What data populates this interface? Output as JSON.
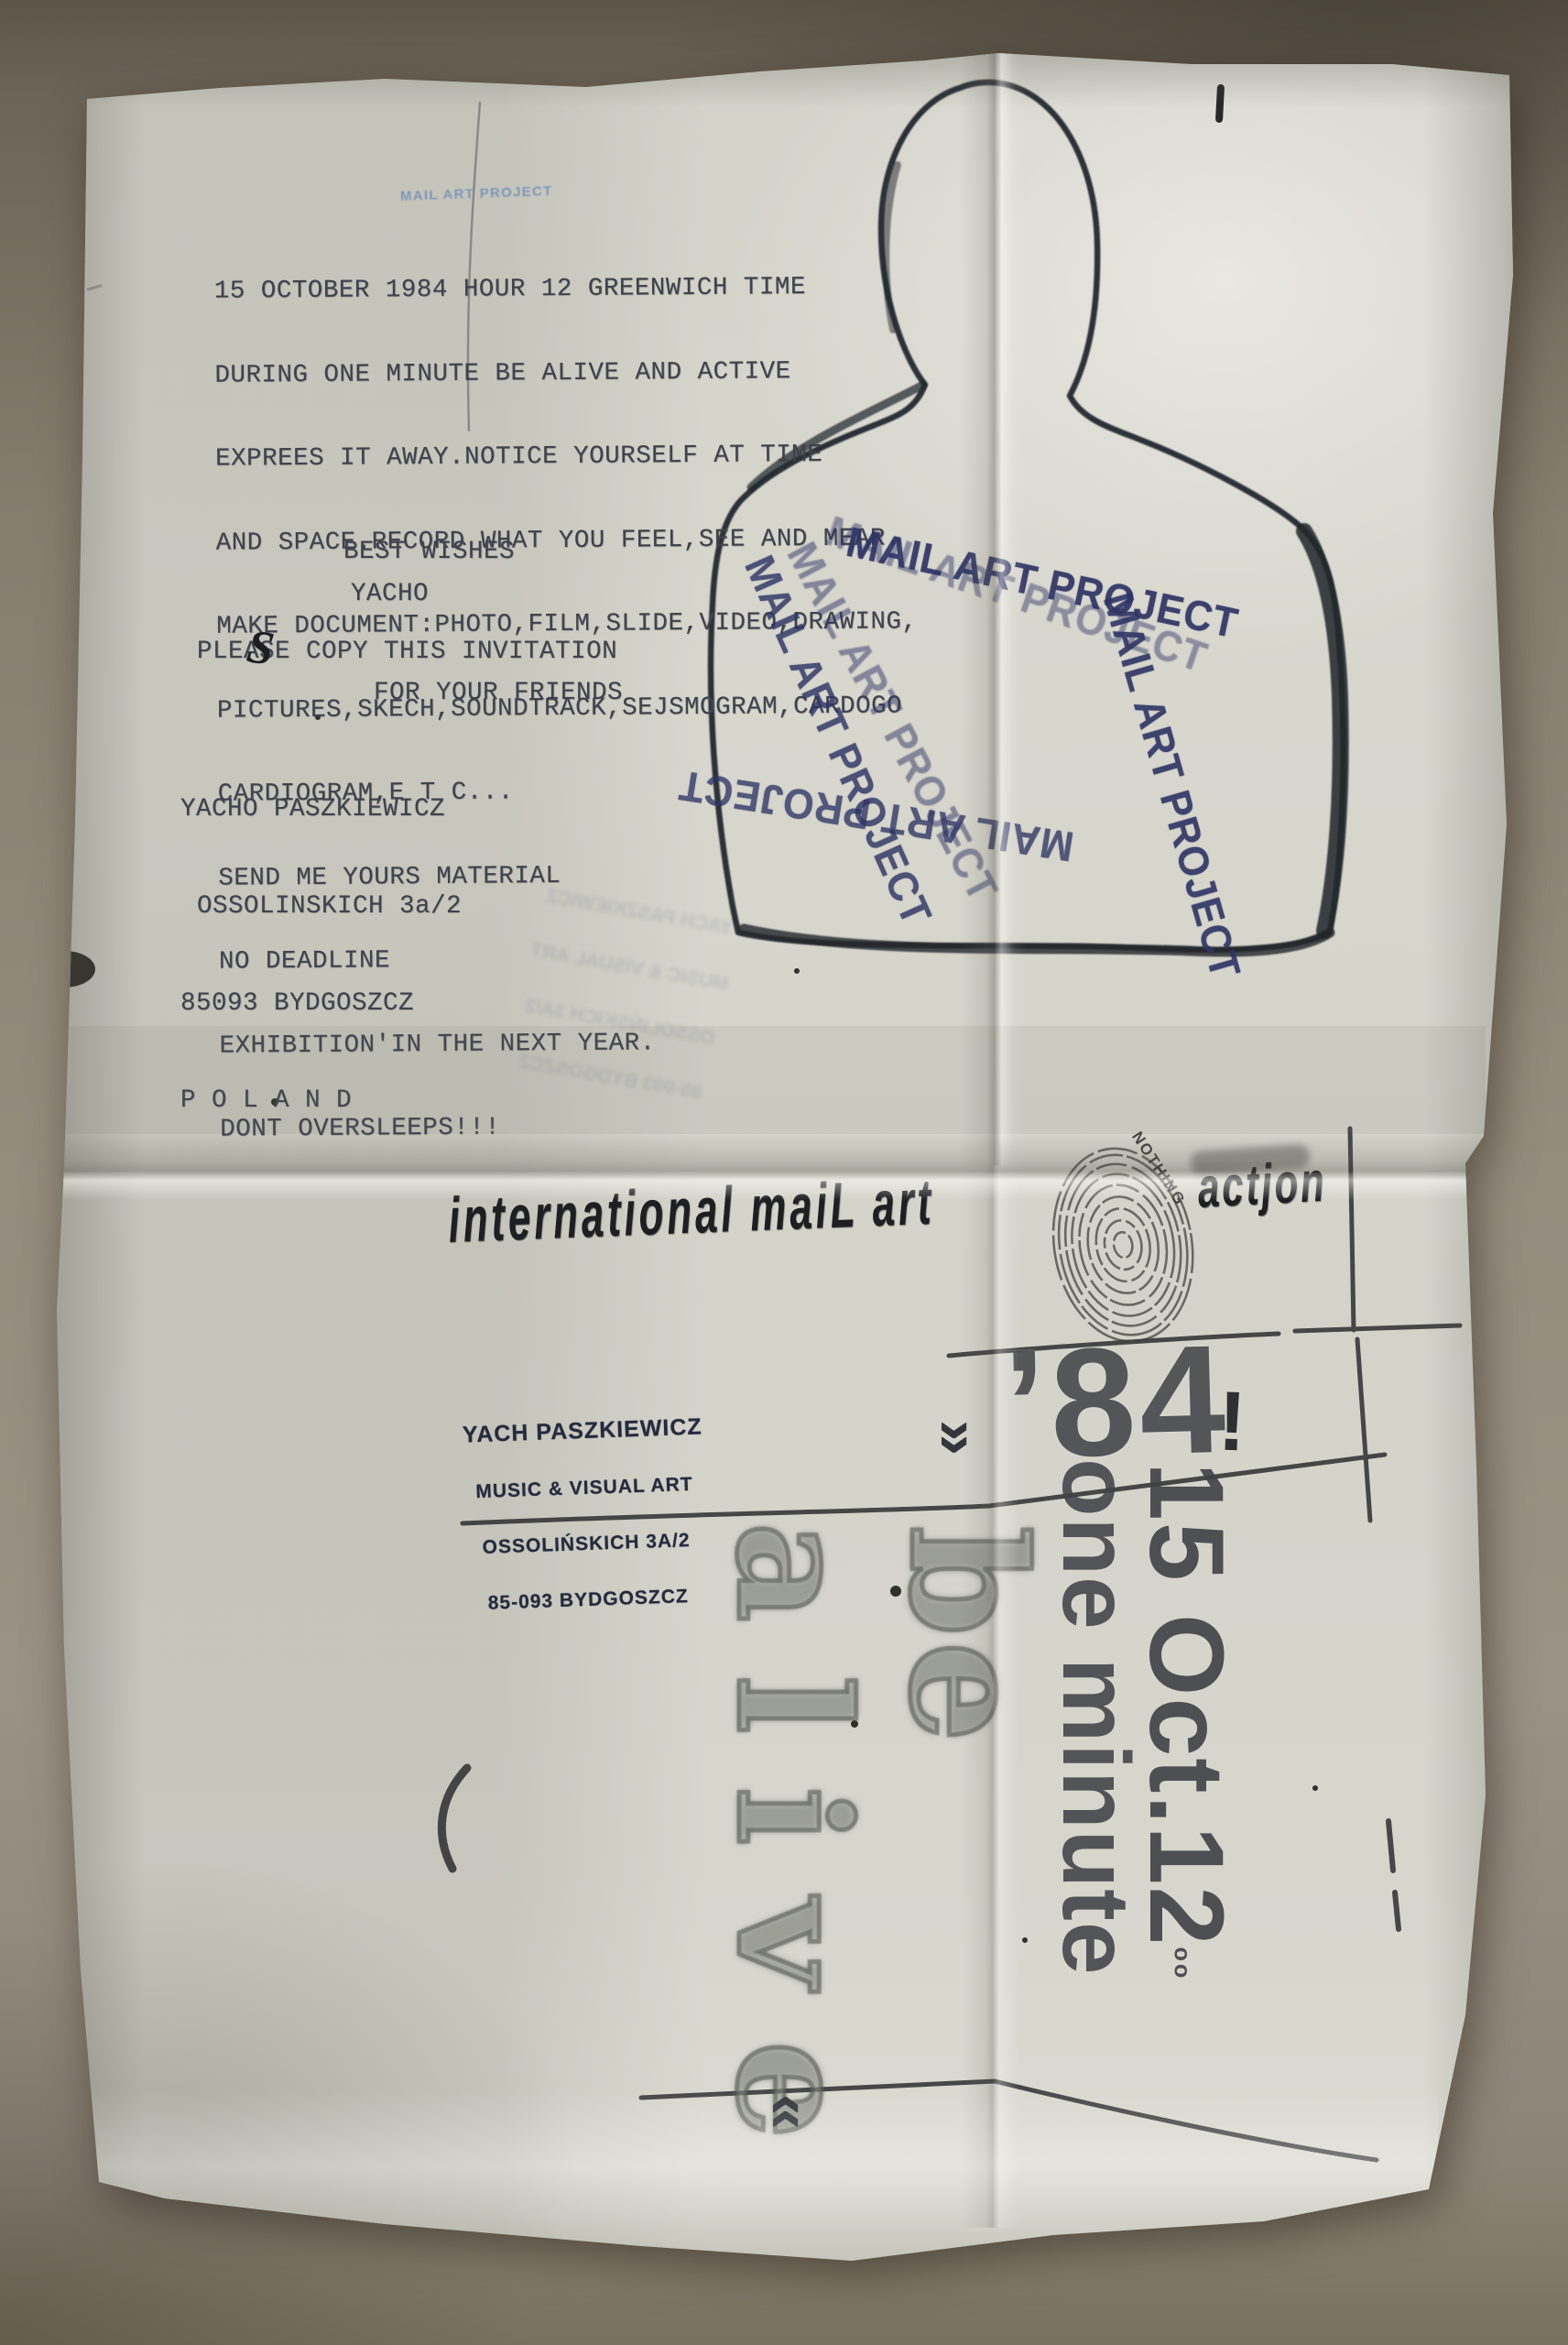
{
  "colors": {
    "paper": "#d7d6cd",
    "table_background": "#8b8375",
    "ink_typewriter": "#3f434d",
    "ink_stamp_navy": "#2e3464",
    "ink_stamp_light_blue": "#7692b8",
    "ink_print_black": "#1d1f22"
  },
  "letter": {
    "blue_stamp": "MAIL ART PROJECT",
    "body_lines": [
      "15 OCTOBER 1984 HOUR 12 GREENWICH TIME",
      "DURING ONE MINUTE BE ALIVE AND ACTIVE",
      "EXPREES IT AWAY.NOTICE YOURSELF AT TIME",
      "AND SPACE.RECORD WHAT YOU FEEL,SEE AND MEAR.",
      "MAKE DOCUMENT:PHOTO,FILM,SLIDE,VIDEO,DRAWING,",
      "PICTURES,SKECH,SOUNDTRACK,SEJSMOGRAM,CARDOGO",
      "CARDIOGRAM,E T C...",
      "SEND ME YOURS MATERIAL",
      "NO DEADLINE",
      "EXHIBITION'IN THE NEXT YEAR.",
      "DONT OVERSLEEPS!!!"
    ],
    "closing": "BEST WISHES",
    "signature": "YACHO",
    "copy_line1": "PLEASE COPY THIS INVITATION",
    "copy_line2": "FOR YOUR FRIENDS",
    "handwritten_s": "S",
    "address_lines": [
      "YACHO PASZKIEWICZ",
      "OSSOLINSKICH 3a/2",
      "85093 BYDGOSZCZ",
      "P O L A N D"
    ]
  },
  "stamps": {
    "label": "MAIL ART PROJECT"
  },
  "poster": {
    "headline_left": "international maiL art",
    "headline_right": "actjon",
    "fingerprint_note": "NOTHING",
    "sender_stamp_lines": [
      "YACH PASZKIEWICZ",
      "MUSIC & VISUAL ART",
      "OSSOLIŃSKICH 3A/2",
      "85-093 BYDGOSZCZ"
    ],
    "year": "’84",
    "exclamation": "!",
    "date_rotated": "15 Oct.12",
    "date_superscript": "oo",
    "duration_rotated": "one minute",
    "slogan_word_1": "be",
    "slogan_word_2": "alive",
    "chevron_down": "»",
    "chevron_up": "«"
  }
}
